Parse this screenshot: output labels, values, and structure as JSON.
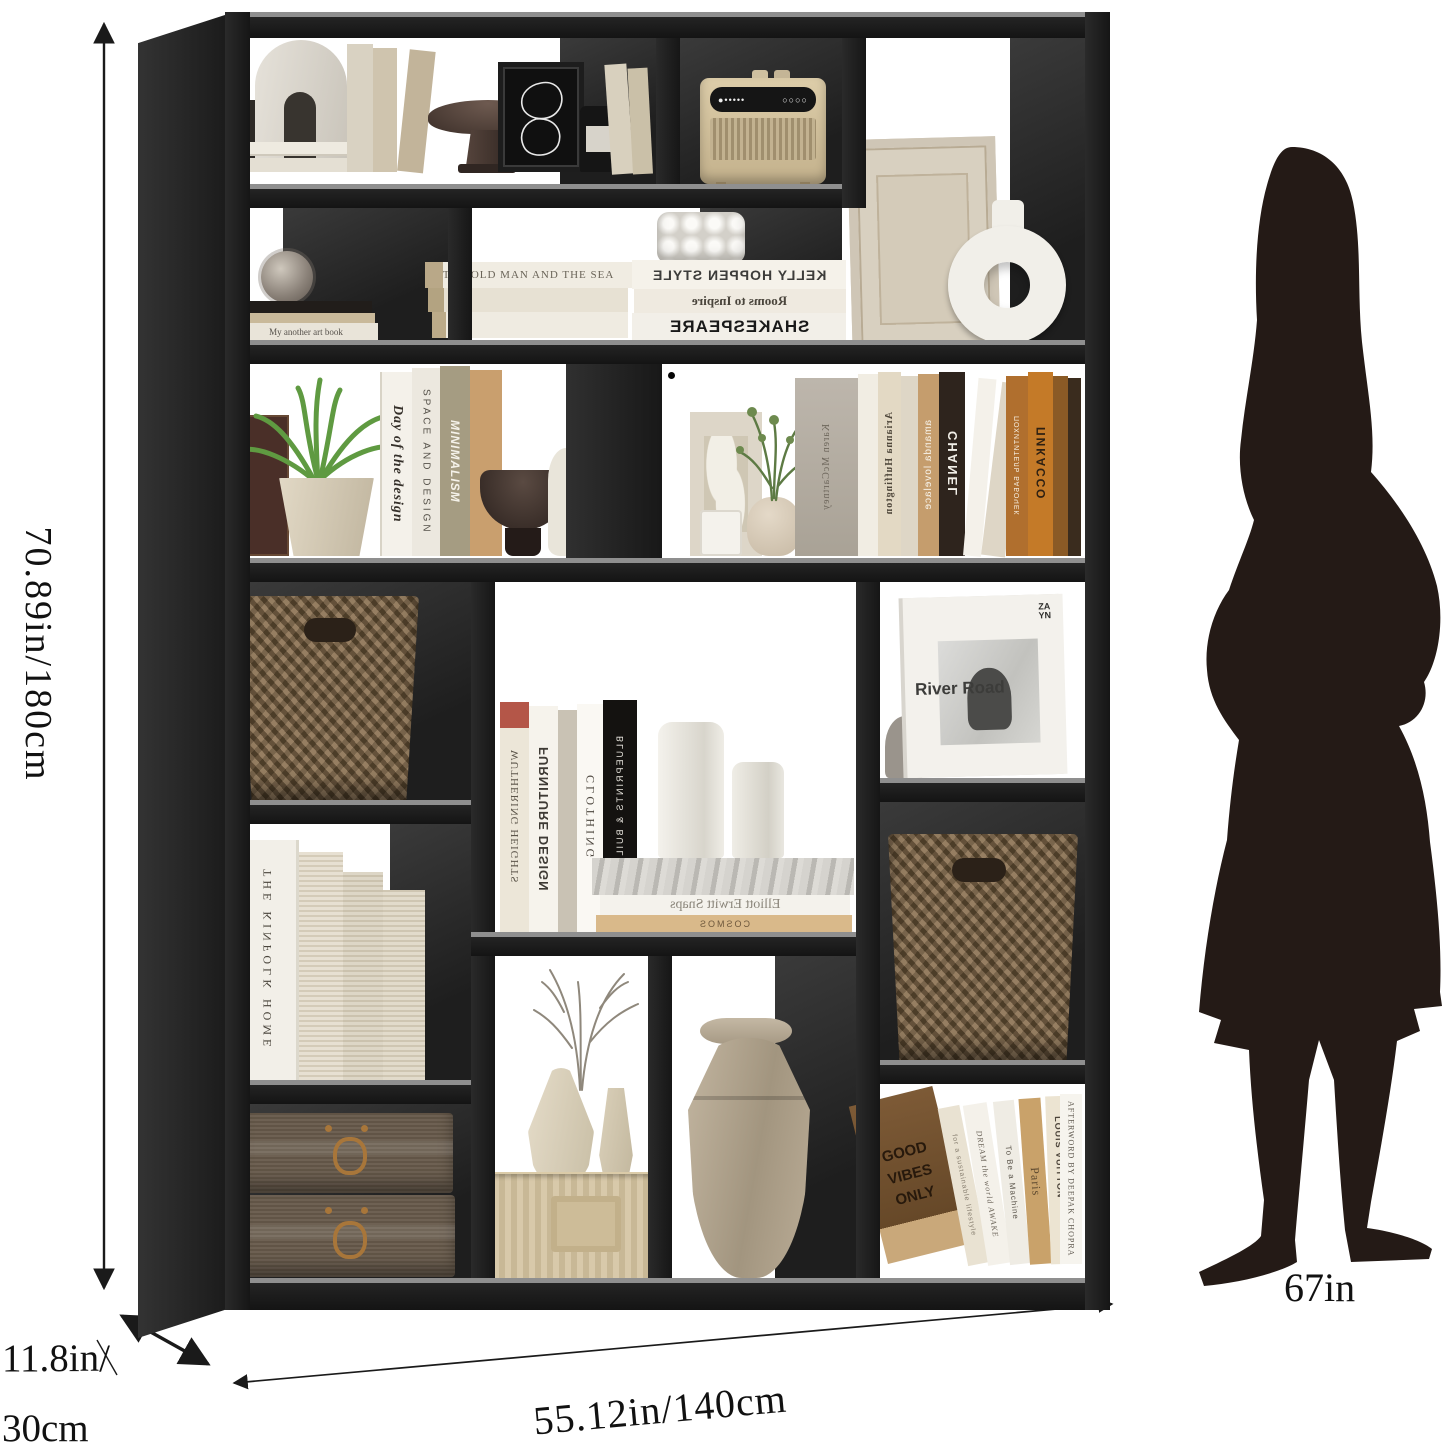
{
  "dimensions": {
    "height": "70.89in/180cm",
    "width": "55.12in/140cm",
    "depth_line1": "11.8in/",
    "depth_line2": "30cm",
    "person_height": "67in"
  },
  "colors": {
    "frame": "#1f1f1f",
    "back_panel": "#2e2e2e",
    "silhouette": "#241a16",
    "dimension_line": "#1a1a1a",
    "basket": "#8a7050",
    "storage_box": "#66594a",
    "radio_body": "#d6c6a4",
    "large_vase": "#b3a693"
  },
  "books": {
    "old_man_sea": "THE OLD MAN AND THE SEA",
    "kelly_hoppen": "KELLY HOPPEN STYLE",
    "rooms_to_inspire": "Rooms to Inspire",
    "shakespeare": "SHAKESPEARE",
    "my_art_book": "My another art book",
    "day_of_design": "Day of the design",
    "space_and_design": "SPACE AND DESIGN",
    "minimalism": "MINIMALISM",
    "karen_mccartney": "Karen McCartney",
    "arianna_huffington": "Arianna Huffington",
    "amanda_lovelace": "amanda lovelace",
    "chanel": "CHANEL",
    "pokhititel": "ПОХИТИТЕЛЬ БАБОЧЕК",
    "picasso": "ПИКАССО",
    "river_road": "River Road",
    "zayn_line1": "ZA",
    "zayn_line2": "YN",
    "wuthering": "WUTHERING HEIGHTS",
    "furniture_design": "FURNITURE DESIGN",
    "clothing": "CLOTHING",
    "blueprints": "BLUEPRINTS & BUILDINGS",
    "elliott_erwitt": "Elliott Erwitt Snaps",
    "cosmos": "COSMOS",
    "kinfolk": "THE KINFOLK HOME",
    "good_vibes": "GOOD VIBES ONLY",
    "sustainable": "for a sustainable lifestyle",
    "dream_awake": "DREAM the world AWAKE",
    "to_be_machine": "To Be a Machine",
    "paris": "Paris",
    "louis_vuitton": "LOUIS VUITTON",
    "catwalk": "CATWALK",
    "afterword": "AFTERWORD BY DEEPAK CHOPRA"
  }
}
